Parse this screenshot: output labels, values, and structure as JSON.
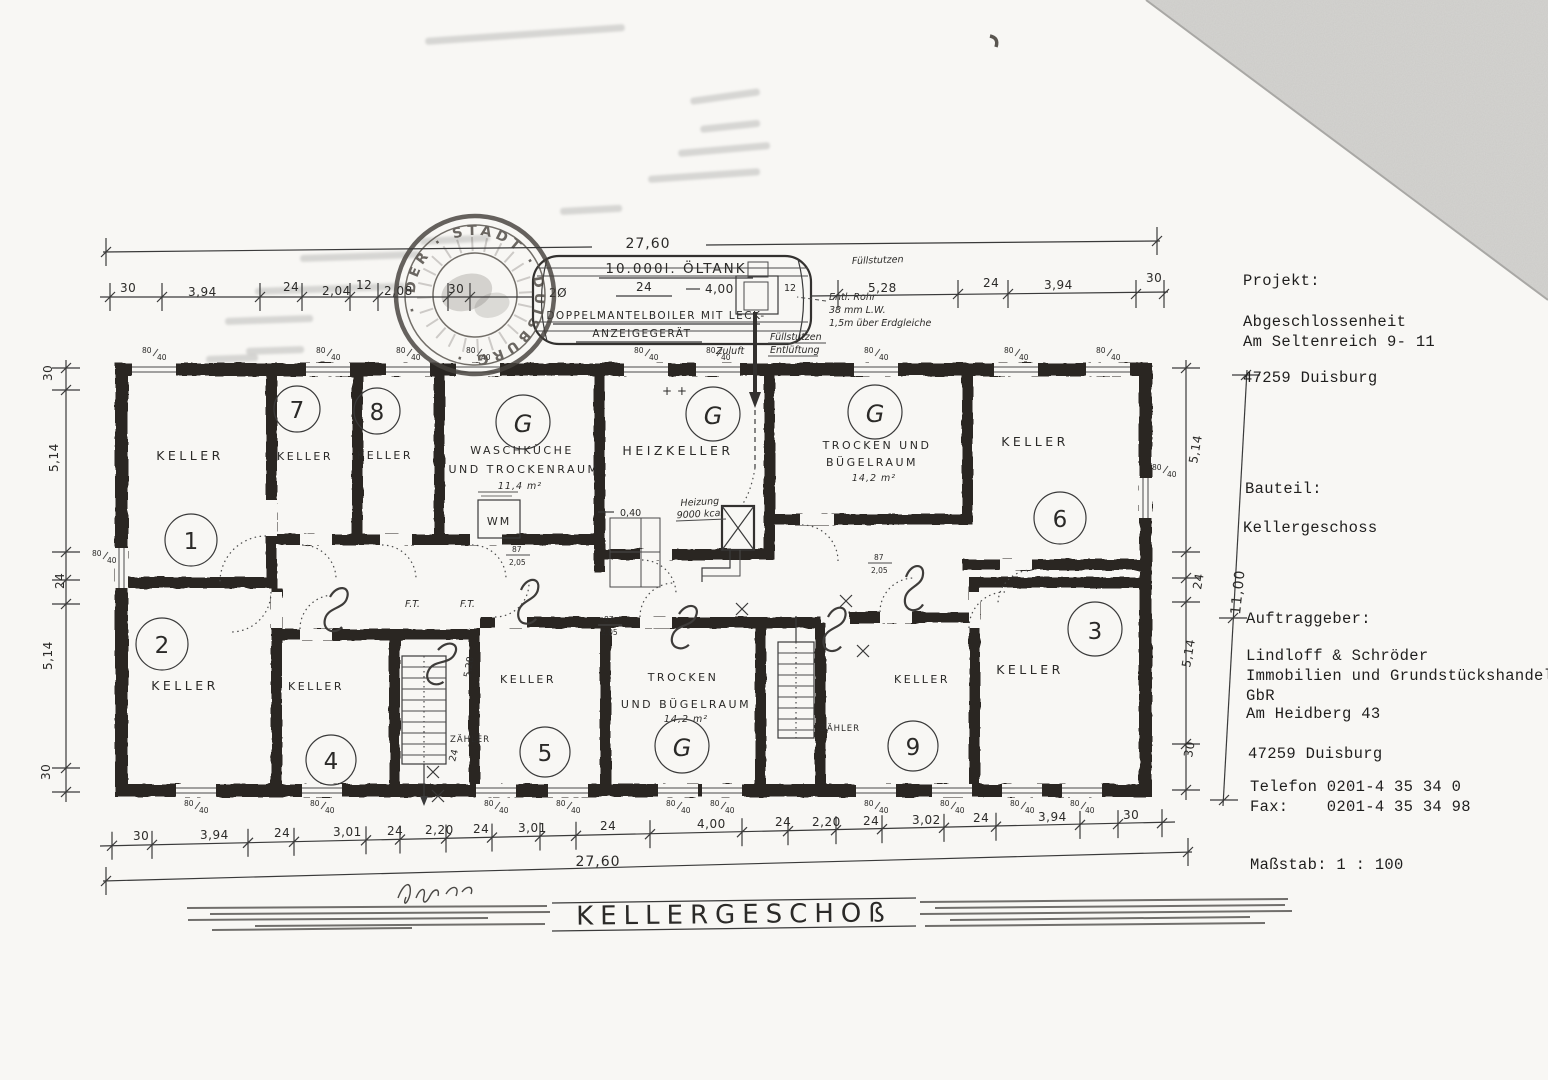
{
  "drawing": {
    "title": "KELLERGESCHOß",
    "overall_width_top": "27,60",
    "overall_width_bottom": "27,60",
    "overall_height": "11,00"
  },
  "info_panel": {
    "projekt_label": "Projekt:",
    "projekt_line1": "Abgeschlossenheit",
    "projekt_line2": "Am Seltenreich 9- 11",
    "projekt_city": "47259 Duisburg",
    "bauteil_label": "Bauteil:",
    "bauteil_value": "Kellergeschoss",
    "auftraggeber_label": "Auftraggeber:",
    "client_line1": "Lindloff & Schröder",
    "client_line2": "Immobilien und Grundstückshandel",
    "client_line3": "GbR",
    "client_line4": "Am Heidberg 43",
    "client_city": "47259 Duisburg",
    "telefon": "Telefon 0201-4 35 34 0",
    "fax": "Fax:    0201-4 35 34 98",
    "massstab": "Maßstab: 1 : 100"
  },
  "tank": {
    "capacity_label": "10.000l. ÖLTANK",
    "type_line1": "DOPPELMANTELBOILER MIT LECK-",
    "type_line2": "ANZEIGEGERÄT",
    "dim_diameter": "2Ø",
    "dim_24": "24",
    "dim_length": "4,00",
    "dim_12": "12",
    "note_entl_1": "Entl. Rohr",
    "note_entl_2": "38 mm L.W.",
    "note_entl_3": "1,5m über Erdgleiche",
    "note_fuellstutzen": "Füllstutzen",
    "note_entlueftung": "Entlüftung",
    "note_zuluft": "Zuluft"
  },
  "stamp": {
    "ring_text": "· DER · STADT · DUISBURG ·"
  },
  "rooms": [
    {
      "number": "1",
      "name": "KELLER"
    },
    {
      "number": "2",
      "name": "KELLER"
    },
    {
      "number": "3",
      "name": "KELLER"
    },
    {
      "number": "4",
      "name": "KELLER"
    },
    {
      "number": "5",
      "name": "KELLER"
    },
    {
      "number": "6",
      "name": "KELLER"
    },
    {
      "number": "7",
      "name": "KELLER"
    },
    {
      "number": "8",
      "name": "KELLER"
    },
    {
      "number": "9",
      "name": "KELLER"
    },
    {
      "number": "G",
      "line1": "WASCHKÜCHE",
      "line2": "UND TROCKENRAUM",
      "area": "11,4 m²"
    },
    {
      "number": "G",
      "name": "HEIZKELLER"
    },
    {
      "number": "G",
      "line1": "TROCKEN UND",
      "line2": "BÜGELRAUM",
      "area": "14,2 m²"
    },
    {
      "number": "G",
      "line1": "TROCKEN",
      "line2": "UND BÜGELRAUM",
      "area": "14,2 m²"
    }
  ],
  "labels": {
    "zaehler": "ZÄHLER",
    "ft": "F.T.",
    "heizung_1": "Heizung",
    "heizung_2": "9000 kcal",
    "level": "0,40",
    "wm": "WM",
    "plus": "+ +",
    "door_w": "87",
    "door_h": "2,05",
    "stair24": "24",
    "stair_dim": "5,28"
  },
  "dims": {
    "top": [
      "30",
      "3,94",
      "24",
      "2,04",
      "12",
      "2,08",
      "30",
      "5,28",
      "24",
      "3,94",
      "30"
    ],
    "bottom": [
      "30",
      "3,94",
      "24",
      "3,01",
      "24",
      "2,20",
      "24",
      "3,01",
      "24",
      "4,00",
      "24",
      "2,20",
      "24",
      "3,02",
      "24",
      "3,94",
      "30"
    ],
    "left": [
      "30",
      "5,14",
      "24",
      "5,14",
      "30"
    ],
    "right": [
      "5,14",
      "24",
      "5,14",
      "30"
    ],
    "win_w": "80",
    "win_h": "40"
  }
}
